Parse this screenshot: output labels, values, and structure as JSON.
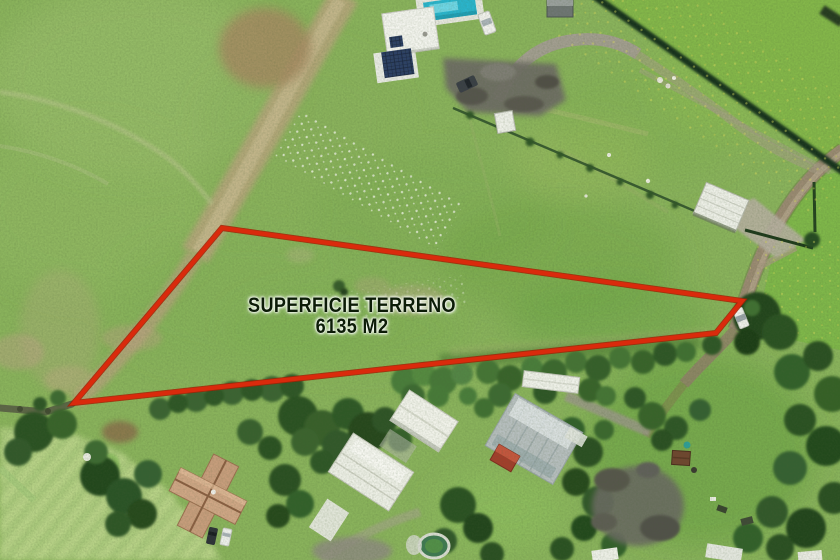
{
  "annotation": {
    "surface_label": "SUPERFICIE TERRENO",
    "area_label": "6135 M2",
    "boundary_points": "222,228 742,301 716,333 74,403",
    "boundary_color": "#da2a0c",
    "boundary_underlay_color": "#a32105",
    "label_color": "#0c1c07"
  }
}
